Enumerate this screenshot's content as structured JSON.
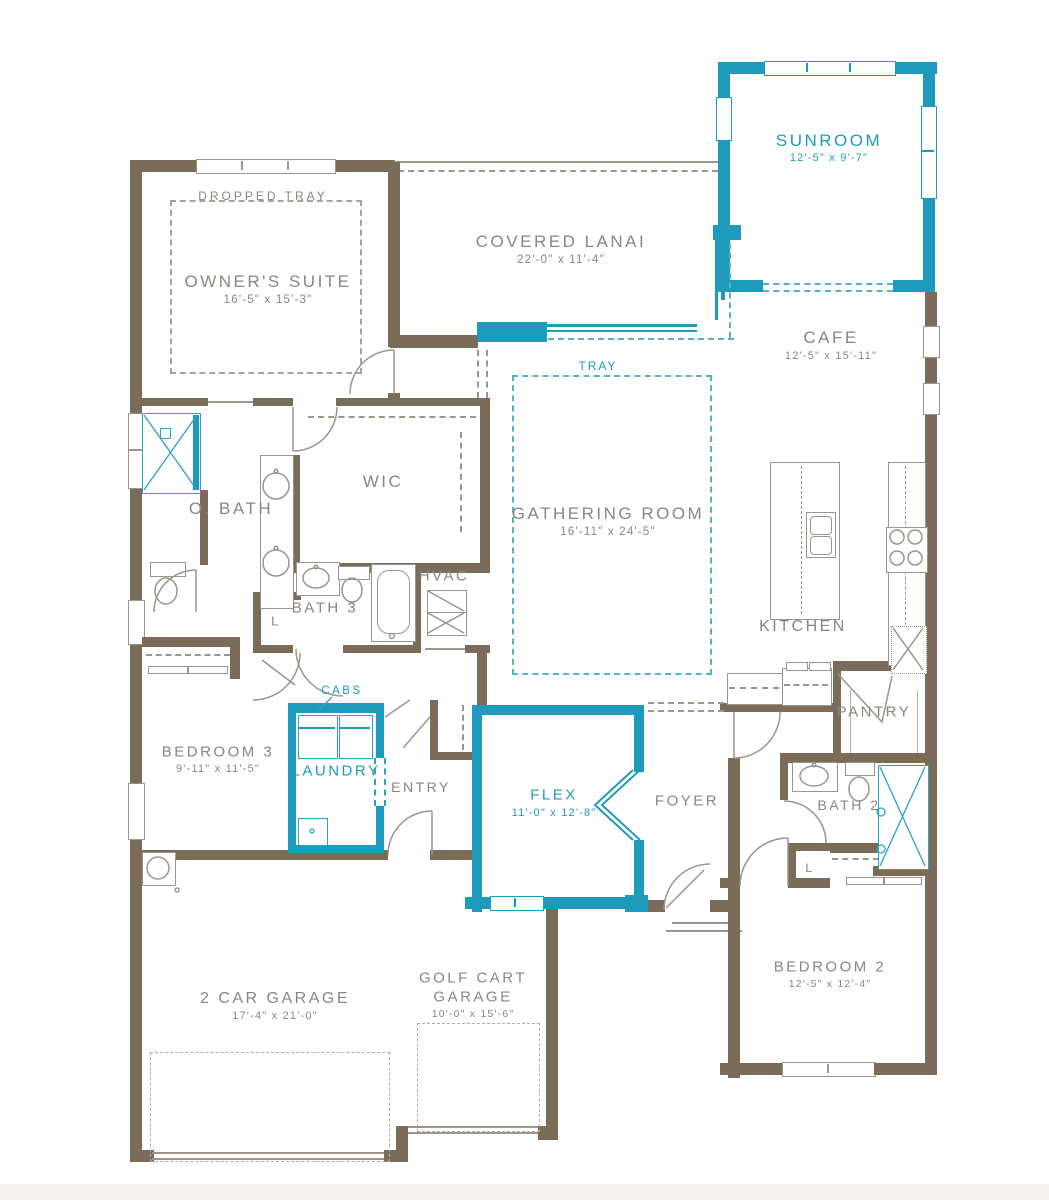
{
  "plan": {
    "colors": {
      "wall": "#7b6c59",
      "accent": "#1e9abd",
      "line": "#9b958c",
      "text": "#8b867e"
    },
    "rooms": {
      "owners_suite": {
        "name": "OWNER'S SUITE",
        "dims": "16'-5\" x 15'-3\""
      },
      "dropped_tray": {
        "label": "DROPPED TRAY"
      },
      "covered_lanai": {
        "name": "COVERED LANAI",
        "dims": "22'-0\" x 11'-4\""
      },
      "sunroom": {
        "name": "SUNROOM",
        "dims": "12'-5\" x 9'-7\""
      },
      "cafe": {
        "name": "CAFE",
        "dims": "12'-5\" x 15'-11\""
      },
      "tray": {
        "label": "TRAY"
      },
      "gathering_room": {
        "name": "GATHERING ROOM",
        "dims": "16'-11\" x 24'-5\""
      },
      "wic": {
        "name": "WIC"
      },
      "o_bath": {
        "name": "O. BATH"
      },
      "bath_3": {
        "name": "BATH 3"
      },
      "hvac": {
        "name": "HVAC"
      },
      "linen_1": {
        "label": "L"
      },
      "kitchen": {
        "name": "KITCHEN"
      },
      "pantry": {
        "name": "PANTRY"
      },
      "bedroom_3": {
        "name": "BEDROOM 3",
        "dims": "9'-11\" x 11'-5\""
      },
      "laundry": {
        "name": "LAUNDRY"
      },
      "cabs": {
        "label": "CABS"
      },
      "entry": {
        "name": "ENTRY"
      },
      "flex": {
        "name": "FLEX",
        "dims": "11'-0\" x 12'-8\""
      },
      "foyer": {
        "name": "FOYER"
      },
      "bath_2": {
        "name": "BATH 2"
      },
      "linen_2": {
        "label": "L"
      },
      "bedroom_2": {
        "name": "BEDROOM 2",
        "dims": "12'-5\" x 12'-4\""
      },
      "two_car_garage": {
        "name": "2 CAR GARAGE",
        "dims": "17'-4\" x 21'-0\""
      },
      "golf_cart_garage": {
        "name": "GOLF CART GARAGE",
        "dims": "10'-0\" x 15'-6\""
      }
    }
  }
}
